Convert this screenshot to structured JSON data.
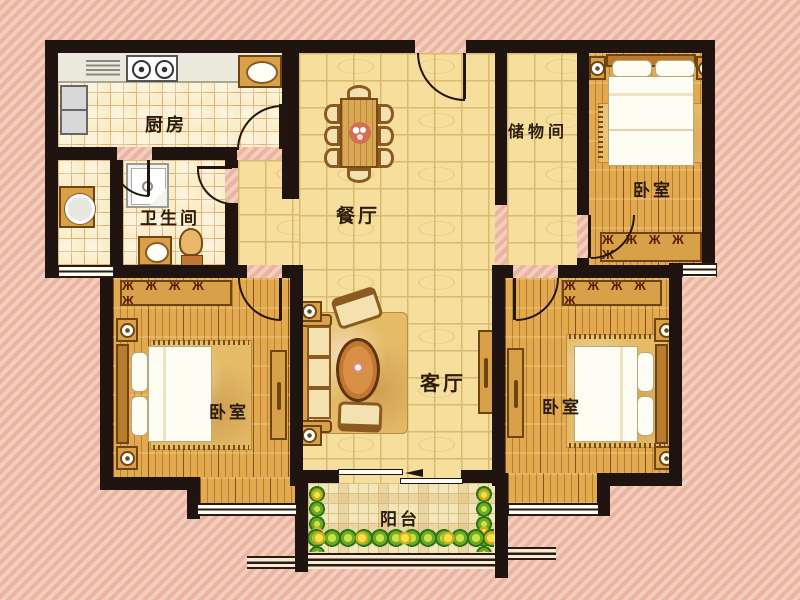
{
  "rooms": {
    "kitchen": {
      "label": "厨房"
    },
    "bathroom": {
      "label": "卫生间"
    },
    "dining_room": {
      "label": "餐厅"
    },
    "storage_room": {
      "label": "储物间"
    },
    "bedroom_northeast": {
      "label": "卧室"
    },
    "bedroom_southwest": {
      "label": "卧室"
    },
    "living_room": {
      "label": "客厅"
    },
    "bedroom_southeast": {
      "label": "卧室"
    },
    "balcony": {
      "label": "阳台"
    }
  },
  "colors": {
    "wall": "#201410",
    "large_tile_floor": "#f6df9c",
    "small_tile_floor": "#f9eecb",
    "wood_floor": "#e3a94e",
    "balcony_floor": "#f3e6ba",
    "background_stripe": "#efc2b0",
    "furniture_wood": "#d9a04a",
    "plant_green": "#6aab28",
    "plant_yellow": "#e8d42c"
  }
}
